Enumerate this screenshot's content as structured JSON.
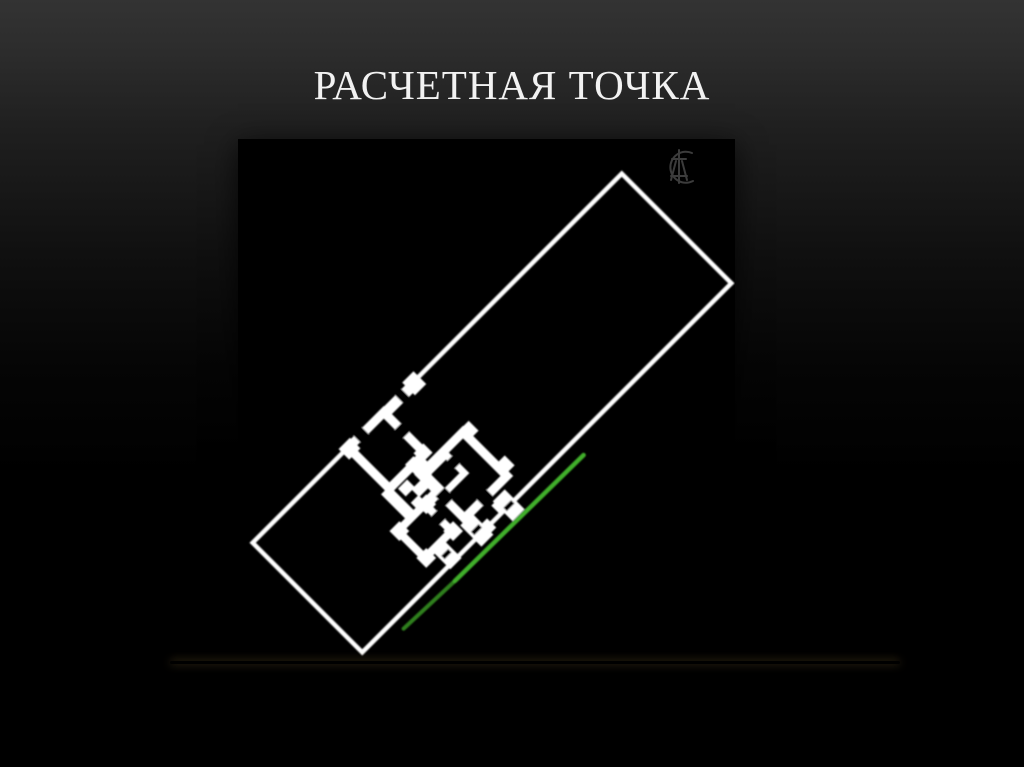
{
  "slide": {
    "title": "РАСЧЕТНАЯ ТОЧКА"
  },
  "figure": {
    "watermark_icon": "ct-monogram-icon",
    "colors": {
      "plan_outline": "#ffffff",
      "calc_line_bright": "#3fae2a",
      "calc_line_dark": "#2d7f1e",
      "watermark": "#3c3c3c",
      "background": "#000000"
    }
  },
  "divider": {
    "color_center": "#d8b56e",
    "color_edge": "#6b5526"
  },
  "background": {
    "top": "#333333",
    "bottom": "#000000"
  }
}
